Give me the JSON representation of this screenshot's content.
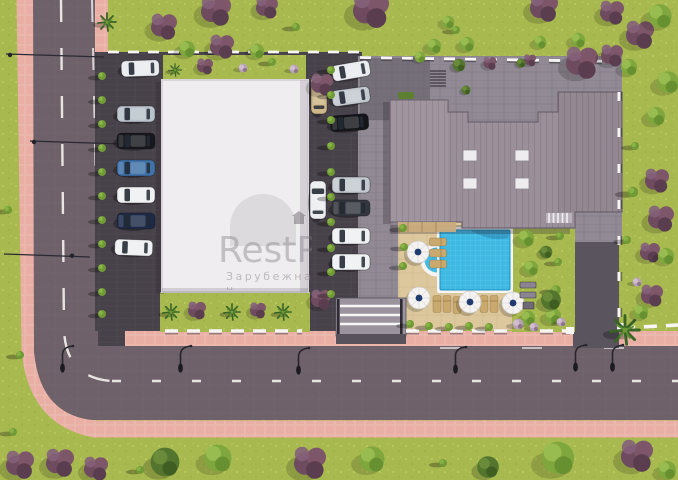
{
  "watermark": {
    "title": "RestP",
    "subtitle": "Зарубежная н"
  },
  "palette": {
    "grass": "#a8ba4f",
    "road": "#6e6169",
    "sidewalk": "#e9afa5",
    "parking": "#474149",
    "paving": "#918a94",
    "driveway": "#5a545e",
    "white_roof": "#efedf0",
    "gray_roof": "#9b8f99",
    "pool_water": "#3db9e4",
    "pool_deck": "#ddc89d",
    "umbrella": "#f4f3f1",
    "umbrella_center": "#1f3a6e",
    "tree_green": "#7fa73e",
    "tree_dark": "#54752e",
    "tree_purple": "#6e4b5f",
    "car_glass": "#232a34",
    "lane_line": "#f2f0ed",
    "fence": "#f7f6f4",
    "awning": "#c9ab7d"
  },
  "cars": {
    "top": "#e9ebee",
    "left_column": [
      "#b9c3cb",
      "#17181d",
      "#3f72a8",
      "#eef0f2",
      "#1c2a47",
      "#eef0f2"
    ],
    "middle_column": [
      "#e9ebee",
      "#c3c9cf",
      "#141519",
      "#c3c9cf",
      "#34373f",
      "#eef0f2",
      "#eef0f2"
    ],
    "side_vertical": [
      "#cdb687",
      "#ecedef"
    ]
  }
}
